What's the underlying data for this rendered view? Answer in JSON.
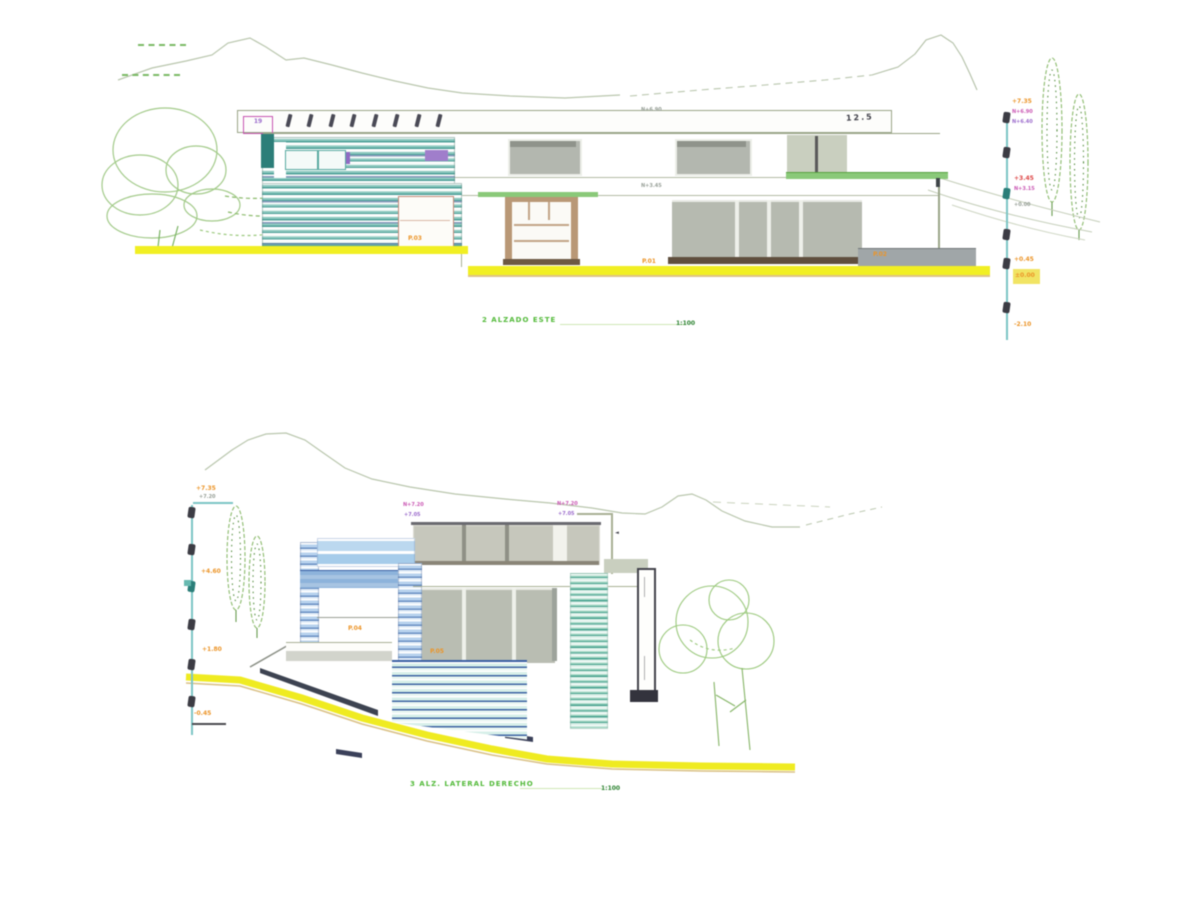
{
  "drawing": {
    "kind": "architectural elevation sheets",
    "background": "#ffffff"
  },
  "palette": {
    "louver_teal": "#4f9d96",
    "louver_blue": "#6b8fc0",
    "glass_gray": "#b9bdb2",
    "ground_yellow": "#f0ee2c",
    "annotation_orange": "#e8952f",
    "annotation_magenta": "#c659b0",
    "annotation_red": "#d84848",
    "annotation_green": "#56b83e",
    "outline_olive": "#9aa58a",
    "level_line_teal": "#7fc4c4",
    "vegetation_green": "#9cc87f"
  },
  "sheet1": {
    "title": "2 ALZADO ESTE",
    "scale_tag": "1:100",
    "parapet_box_tag": "19",
    "parapet_right_tag": "12.5",
    "wall_note_upper": "N+6.90",
    "wall_note_lower": "N+3.45",
    "door_tag": "P.03",
    "entry_tag": "P.01",
    "wall_tag": "P.02",
    "levels": {
      "top": "+7.35",
      "top_note_1": "N+6.90",
      "top_note_2": "N+6.40",
      "mid_red": "+3.45",
      "mid_magenta": "N+3.15",
      "mid_note": "+0.00",
      "ground": "+0.45",
      "ground_highlight": "±0.00",
      "basement": "-2.10"
    }
  },
  "sheet2": {
    "title": "3 ALZ. LATERAL DERECHO",
    "scale_tag": "1:100",
    "roof_note_left_1": "N+7.20",
    "roof_note_left_2": "+7.05",
    "roof_note_right_1": "N+7.20",
    "roof_note_right_2": "+7.05",
    "terrace_tag_1": "P.04",
    "terrace_tag_2": "04",
    "glass_tag": "P.05",
    "levels": {
      "top": "+7.35",
      "top_note": "+7.20",
      "upper": "+4.60",
      "mid": "+1.80",
      "base": "-0.45"
    }
  }
}
